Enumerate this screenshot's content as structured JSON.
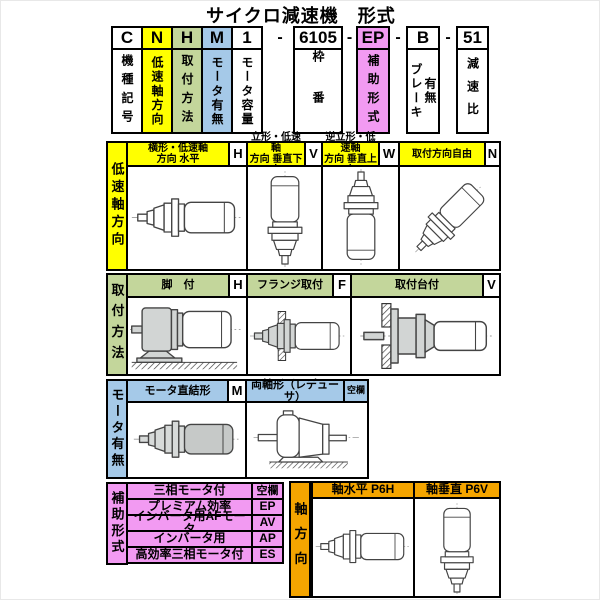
{
  "title": "サイクロ減速機　形式",
  "separator": "-",
  "colors": {
    "yellow": "#FFFF00",
    "green": "#C3D69B",
    "blue": "#A5C9E8",
    "pink": "#F29AF2",
    "orange": "#F5A500"
  },
  "code_units": [
    {
      "code": "C",
      "desc": "機種記号"
    },
    {
      "code": "N",
      "desc": "低速軸方向"
    },
    {
      "code": "H",
      "desc": "取付方法"
    },
    {
      "code": "M",
      "desc": "モータ有無"
    },
    {
      "code": "1",
      "desc": "モータ容量"
    },
    {
      "code": "6105",
      "desc": "枠番"
    },
    {
      "code": "EP",
      "desc": "補助形式"
    },
    {
      "code": "B",
      "desc": "ブレーキ",
      "desc2": "有無"
    },
    {
      "code": "51",
      "desc": "減速比"
    }
  ],
  "low_speed_shaft_section": {
    "label": "低速軸方向",
    "items": [
      {
        "title1": "横形・低速軸",
        "title2": "方向 水平",
        "code": "H",
        "icon": "motor-horizontal"
      },
      {
        "title1": "立形・低速軸",
        "title2": "方向 垂直下向",
        "code": "V",
        "icon": "motor-vertical-down"
      },
      {
        "title1": "逆立形・低速軸",
        "title2": "方向 垂直上向",
        "code": "W",
        "icon": "motor-vertical-up"
      },
      {
        "title1": "取付方向自由",
        "title2": "",
        "code": "N",
        "icon": "motor-diagonal"
      }
    ]
  },
  "mounting_section": {
    "label": "取付方法",
    "items": [
      {
        "title": "脚　付",
        "code": "H",
        "icon": "motor-foot-mounted"
      },
      {
        "title": "フランジ取付",
        "code": "F",
        "icon": "motor-flange-mounted"
      },
      {
        "title": "取付台付",
        "code": "V",
        "icon": "motor-base-mounted"
      }
    ]
  },
  "motor_section": {
    "label": "モータ有無",
    "items": [
      {
        "title": "モータ直結形",
        "code": "M",
        "icon": "motor-direct-coupled"
      },
      {
        "title": "両軸形（レデューサ）",
        "code": "空欄",
        "icon": "reducer-double-shaft"
      }
    ]
  },
  "auxiliary_section": {
    "label": "補助形式",
    "rows": [
      {
        "name": "三相モータ付",
        "code": "空欄"
      },
      {
        "name": "プレミアム効率",
        "code": "EP"
      },
      {
        "name": "インバータ用AFモータ",
        "code": "AV"
      },
      {
        "name": "インバータ用",
        "code": "AP"
      },
      {
        "name": "高効率三相モータ付",
        "code": "ES"
      }
    ]
  },
  "axis_section": {
    "label": "軸方向",
    "items": [
      {
        "title": "軸水平 P6H",
        "icon": "motor-horizontal"
      },
      {
        "title": "軸垂直 P6V",
        "icon": "motor-vertical-down"
      }
    ]
  }
}
